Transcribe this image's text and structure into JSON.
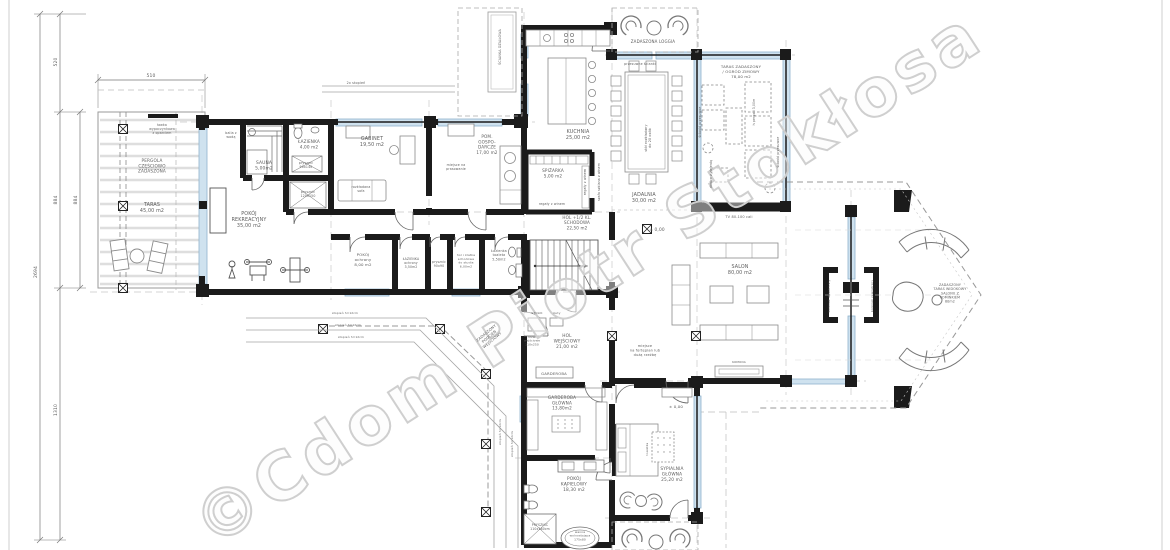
{
  "watermark": {
    "text": "©Cdom Piotr Stokłosa"
  },
  "colors": {
    "wall": "#1b1b1b",
    "glass_fill": "#cfe2ef",
    "glass_stroke": "#8fb3cd",
    "thin_line": "#8a8a8a",
    "axis_dash": "#c8c8c8",
    "text": "#5c5c5c",
    "watermark": "#cfcfcf",
    "background": "#ffffff"
  },
  "dimensions": {
    "top_width": "510",
    "left_segment_top": "520",
    "left_segment_mid_outer": "884",
    "left_segment_mid_inner": "884",
    "left_segment_bottom": "1310",
    "left_total": "2694"
  },
  "labels": [
    {
      "id": "dim-top-510",
      "x": 151,
      "y": 77,
      "fs": 4.5,
      "lines": [
        "510"
      ]
    },
    {
      "id": "dim-left-520",
      "x": 57,
      "y": 62,
      "fs": 4.5,
      "rot": -90,
      "lines": [
        "520"
      ]
    },
    {
      "id": "dim-left-884-outer",
      "x": 57,
      "y": 200,
      "fs": 4.5,
      "rot": -90,
      "lines": [
        "884"
      ]
    },
    {
      "id": "dim-left-884-inner",
      "x": 77,
      "y": 200,
      "fs": 4.5,
      "rot": -90,
      "lines": [
        "884"
      ]
    },
    {
      "id": "dim-left-1310",
      "x": 57,
      "y": 410,
      "fs": 4.5,
      "rot": -90,
      "lines": [
        "1310"
      ]
    },
    {
      "id": "dim-left-2694",
      "x": 37,
      "y": 272,
      "fs": 4.5,
      "rot": -90,
      "lines": [
        "2694"
      ]
    },
    {
      "id": "lawka-wypoczynkowa",
      "x": 162,
      "y": 126,
      "fs": 3.2,
      "lines": [
        "ławka",
        "wypoczynkowa",
        "z oparciem"
      ]
    },
    {
      "id": "pergola",
      "x": 152,
      "y": 162,
      "fs": 4.2,
      "lines": [
        "PERGOLA",
        "CZĘŚCIOWO",
        "ZADASZONA"
      ]
    },
    {
      "id": "taras",
      "x": 152,
      "y": 206,
      "fs": 4.8,
      "lines": [
        "TARAS",
        "45,00 m2"
      ]
    },
    {
      "id": "balia",
      "x": 231,
      "y": 134,
      "fs": 3.2,
      "lines": [
        "balia z",
        "wodą"
      ]
    },
    {
      "id": "sauna",
      "x": 264,
      "y": 164,
      "fs": 4.4,
      "lines": [
        "SAUNA",
        "5,00m2"
      ]
    },
    {
      "id": "lazienka",
      "x": 309,
      "y": 143,
      "fs": 4.2,
      "lines": [
        "ŁAZIENKA",
        "4,00 m2"
      ]
    },
    {
      "id": "prysznic-90x140",
      "x": 306,
      "y": 164,
      "fs": 3.2,
      "lines": [
        "prysznic",
        "90x140"
      ]
    },
    {
      "id": "prysznic-120x150",
      "x": 308,
      "y": 193,
      "fs": 3.2,
      "lines": [
        "prysznic",
        "120x150"
      ]
    },
    {
      "id": "pokoj-rekreacyjny",
      "x": 249,
      "y": 215,
      "fs": 4.8,
      "lines": [
        "POKÓJ",
        "REKREACYJNY",
        "35,00 m2"
      ]
    },
    {
      "id": "gabinet",
      "x": 372,
      "y": 140,
      "fs": 4.8,
      "lines": [
        "GABINET",
        "19,50 m2"
      ]
    },
    {
      "id": "rozkladana-sofa",
      "x": 361,
      "y": 188,
      "fs": 3.2,
      "lines": [
        "rozkładana",
        "sofa"
      ]
    },
    {
      "id": "pom-gospodarcze",
      "x": 487,
      "y": 138,
      "fs": 4.2,
      "lines": [
        "POM.",
        "GOSPO-",
        "DARCZE",
        "17,00 m2"
      ]
    },
    {
      "id": "miejsce-prasowanie",
      "x": 456,
      "y": 166,
      "fs": 3.2,
      "lines": [
        "miejsce na",
        "prasowanie"
      ]
    },
    {
      "id": "kuchnia",
      "x": 578,
      "y": 133,
      "fs": 4.8,
      "lines": [
        "KUCHNIA",
        "25,00 m2"
      ]
    },
    {
      "id": "spizarka",
      "x": 553,
      "y": 172,
      "fs": 4.2,
      "lines": [
        "SPIŻARKA",
        "5,00 m2"
      ]
    },
    {
      "id": "regaly-winem-pion",
      "x": 586,
      "y": 182,
      "fs": 3.2,
      "rot": -90,
      "lines": [
        "regały z winem"
      ]
    },
    {
      "id": "regaly-winem",
      "x": 552,
      "y": 205,
      "fs": 3.2,
      "lines": [
        "regały z winem"
      ]
    },
    {
      "id": "szafa-wino",
      "x": 600,
      "y": 182,
      "fs": 3.1,
      "rot": -90,
      "lines": [
        "szafa szklana z winem"
      ]
    },
    {
      "id": "hol-schodowa",
      "x": 577,
      "y": 219,
      "fs": 4.1,
      "lines": [
        "HOL +1/2 KL.",
        "SCHODOWA",
        "22,50 m2"
      ]
    },
    {
      "id": "pokoj-ochrony",
      "x": 363,
      "y": 256,
      "fs": 3.9,
      "lines": [
        "POKÓJ",
        "ochrony",
        "8,00 m2"
      ]
    },
    {
      "id": "lazienka-ochrony",
      "x": 411,
      "y": 260,
      "fs": 3.1,
      "lines": [
        "ŁAZIENKA",
        "ochrony",
        "3,50m2"
      ]
    },
    {
      "id": "prysznic-90x90",
      "x": 439,
      "y": 263,
      "fs": 3.1,
      "lines": [
        "prysznic",
        "90x90"
      ]
    },
    {
      "id": "hol-studio",
      "x": 466,
      "y": 256,
      "fs": 3.0,
      "lines": [
        "hol i klatka",
        "schodowa",
        "do studia",
        "6,00m2"
      ]
    },
    {
      "id": "lazienka-toaleta",
      "x": 499,
      "y": 252,
      "fs": 3.3,
      "lines": [
        "Łazienka",
        "toaleta",
        "5,50m2"
      ]
    },
    {
      "id": "zadaszona-loggia",
      "x": 653,
      "y": 43,
      "fs": 4.0,
      "lines": [
        "ZADASZONA   LOGGIA"
      ]
    },
    {
      "id": "przesuwne-scianki",
      "x": 640,
      "y": 65,
      "fs": 3.2,
      "lines": [
        "przesuwne ścianki"
      ]
    },
    {
      "id": "jadalnia",
      "x": 644,
      "y": 196,
      "fs": 4.8,
      "lines": [
        "JADALNIA",
        "30,00 m2"
      ]
    },
    {
      "id": "stol-rozkladany",
      "x": 647,
      "y": 138,
      "fs": 3.3,
      "rot": -90,
      "lines": [
        "stół rozkładany",
        "do 20 osób"
      ]
    },
    {
      "id": "ogrod-zimowy",
      "x": 741,
      "y": 68,
      "fs": 3.9,
      "lines": [
        "TARAS ZADASZONY",
        "/ OGRÓD ZIMOWY",
        "78,00 m2"
      ]
    },
    {
      "id": "h-pergoli",
      "x": 755,
      "y": 112,
      "fs": 3.1,
      "rot": -90,
      "lines": [
        "h pergoli 3,00m"
      ]
    },
    {
      "id": "scianki-przesuwne-w",
      "x": 701,
      "y": 122,
      "fs": 3.1,
      "rot": -90,
      "lines": [
        "ścianki przesuwne"
      ]
    },
    {
      "id": "scianki-przesuwne-e",
      "x": 779,
      "y": 152,
      "fs": 3.1,
      "rot": -90,
      "lines": [
        "ścianki przesuwne"
      ]
    },
    {
      "id": "donice-zielen",
      "x": 712,
      "y": 174,
      "fs": 3.1,
      "rot": -90,
      "lines": [
        "donice z zielenią"
      ]
    },
    {
      "id": "tv",
      "x": 739,
      "y": 218,
      "fs": 3.5,
      "lines": [
        "TV 80-100 cali"
      ]
    },
    {
      "id": "salon-poziom",
      "x": 657,
      "y": 231,
      "fs": 4.3,
      "lines": [
        "± 0,00"
      ]
    },
    {
      "id": "salon",
      "x": 740,
      "y": 268,
      "fs": 4.8,
      "lines": [
        "SALON",
        "80,00 m2"
      ]
    },
    {
      "id": "komoda",
      "x": 739,
      "y": 363,
      "fs": 2.9,
      "lines": [
        "KOMODA"
      ]
    },
    {
      "id": "fortepian",
      "x": 645,
      "y": 347,
      "fs": 3.5,
      "lines": [
        "miejsce",
        "na fortepian lub",
        "dużą rzeźbę"
      ]
    },
    {
      "id": "kominek-wewnetrzny",
      "x": 830,
      "y": 296,
      "fs": 2.9,
      "rot": -90,
      "lines": [
        "kominek dwustronny"
      ]
    },
    {
      "id": "kominek-zewnetrzny",
      "x": 873,
      "y": 296,
      "fs": 2.9,
      "rot": -90,
      "lines": [
        "kominek zewnętrzny"
      ]
    },
    {
      "id": "taras-widokowy",
      "x": 950,
      "y": 286,
      "fs": 3.3,
      "lines": [
        "ZADASZONY",
        "TARAS WIDOKOWY",
        "SALONU Z",
        "KOMINKIEM",
        "80m2"
      ]
    },
    {
      "id": "hol-wejsciowy",
      "x": 567,
      "y": 337,
      "fs": 4.3,
      "lines": [
        "HOL",
        "WEJŚCIOWY",
        "21,00 m2"
      ]
    },
    {
      "id": "stolik",
      "x": 537,
      "y": 314,
      "fs": 2.9,
      "lines": [
        "STOLIK"
      ]
    },
    {
      "id": "buty",
      "x": 557,
      "y": 314,
      "fs": 2.9,
      "lines": [
        "buty"
      ]
    },
    {
      "id": "drzwi-wejsciowe",
      "x": 532,
      "y": 338,
      "fs": 2.9,
      "lines": [
        "drzwi",
        "wejściowe",
        "110x250"
      ]
    },
    {
      "id": "garderoba",
      "x": 554,
      "y": 375,
      "fs": 3.8,
      "lines": [
        "GARDEROBA"
      ]
    },
    {
      "id": "zadaszony-podcien",
      "x": 487,
      "y": 334,
      "fs": 3.7,
      "rot": -40,
      "lines": [
        "ZADASZONY",
        "PODCIEŃ",
        "WEJŚCIOWY"
      ]
    },
    {
      "id": "stopien-1",
      "x": 345,
      "y": 314,
      "fs": 2.9,
      "lines": [
        "stopień h=12cm"
      ]
    },
    {
      "id": "stopien-2",
      "x": 348,
      "y": 326,
      "fs": 2.9,
      "lines": [
        "stopień h=12cm"
      ]
    },
    {
      "id": "stopien-3",
      "x": 351,
      "y": 338,
      "fs": 2.9,
      "lines": [
        "stopień h=12cm"
      ]
    },
    {
      "id": "stopien-4",
      "x": 501,
      "y": 432,
      "fs": 2.9,
      "rot": -90,
      "lines": [
        "stopień h=12cm"
      ]
    },
    {
      "id": "stopien-5",
      "x": 513,
      "y": 444,
      "fs": 2.9,
      "rot": -90,
      "lines": [
        "stopień h=12cm"
      ]
    },
    {
      "id": "garderoba-glowna",
      "x": 562,
      "y": 399,
      "fs": 4.2,
      "lines": [
        "GARDEROBA",
        "GŁÓWNA",
        "13,80m2"
      ]
    },
    {
      "id": "pokoj-kapielowy",
      "x": 574,
      "y": 480,
      "fs": 4.3,
      "lines": [
        "POKÓJ",
        "KĄPIELOWY",
        "18,30 m2"
      ]
    },
    {
      "id": "prysznic-110x180",
      "x": 540,
      "y": 526,
      "fs": 3.1,
      "lines": [
        "PRYSZNIC",
        "110x180cm"
      ]
    },
    {
      "id": "wanna",
      "x": 580,
      "y": 533,
      "fs": 2.9,
      "lines": [
        "wanna",
        "wolnostojąca",
        "175x80"
      ]
    },
    {
      "id": "sypialnia-glowna",
      "x": 672,
      "y": 470,
      "fs": 4.3,
      "lines": [
        "SYPIALNIA",
        "GŁÓWNA",
        "25,20 m2"
      ]
    },
    {
      "id": "sypialnia-poziom",
      "x": 676,
      "y": 408,
      "fs": 3.9,
      "lines": [
        "± 0,00"
      ]
    },
    {
      "id": "toaletka",
      "x": 648,
      "y": 449,
      "fs": 2.9,
      "rot": -90,
      "lines": [
        "toaletka"
      ]
    },
    {
      "id": "scianka-dzialowa",
      "x": 501,
      "y": 47,
      "fs": 3.3,
      "rot": -90,
      "lines": [
        "ŚCIANKA DZIAŁOWA"
      ]
    },
    {
      "id": "stopnie-2x",
      "x": 356,
      "y": 84,
      "fs": 3.3,
      "lines": [
        "2x stopień"
      ]
    }
  ]
}
